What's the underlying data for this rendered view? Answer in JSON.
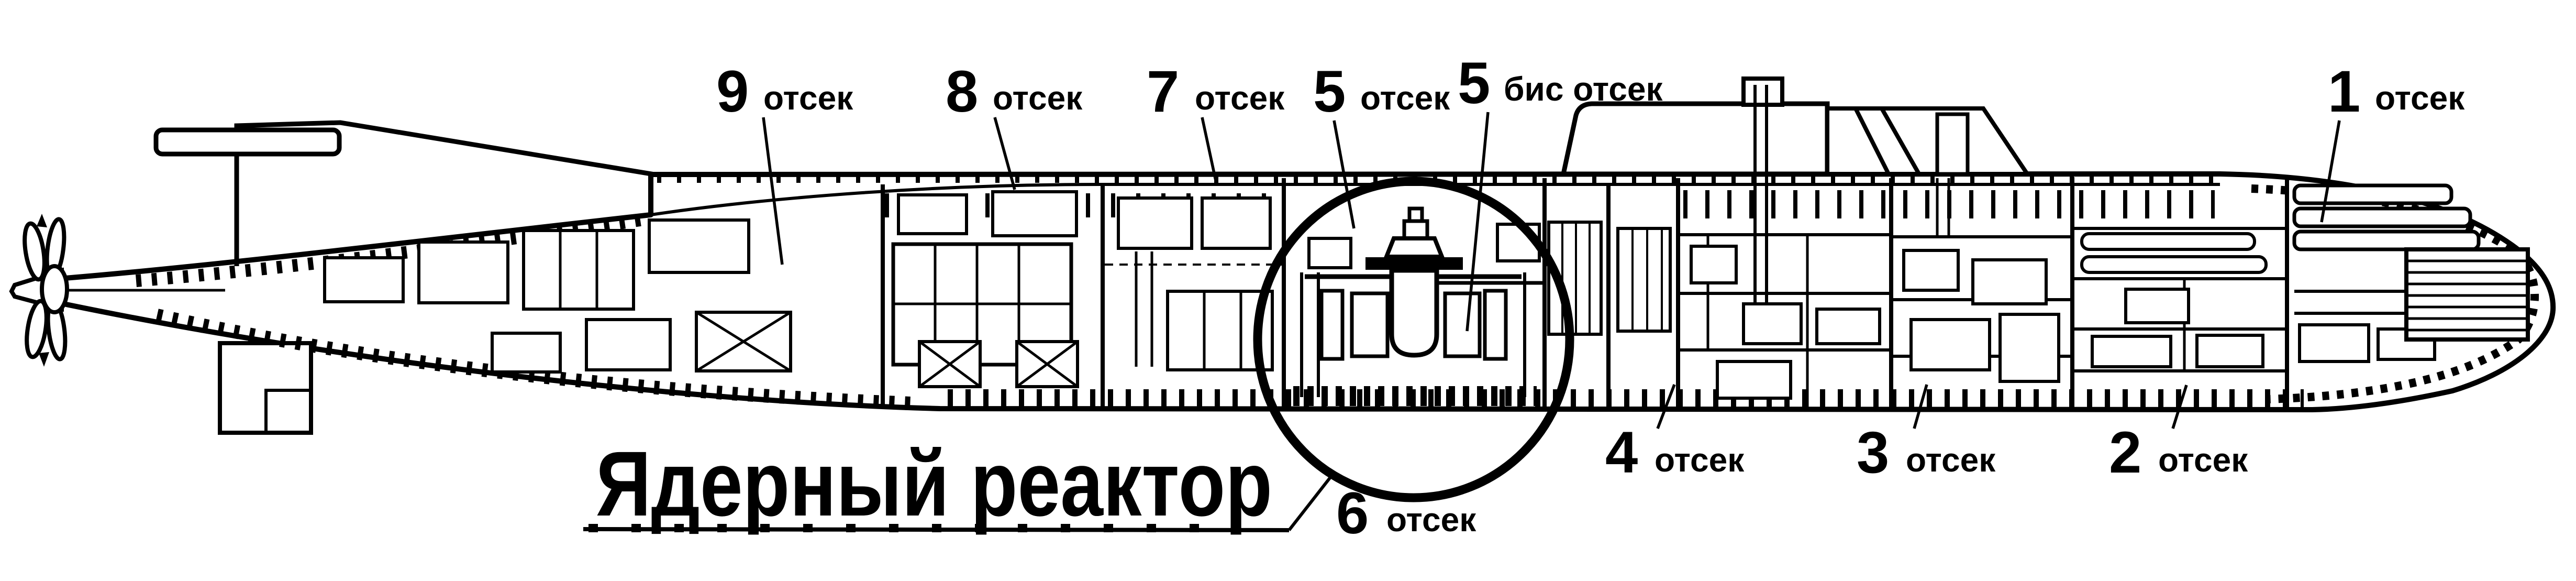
{
  "figure": {
    "type": "submarine-cutaway-diagram",
    "background": "#ffffff",
    "ink": "#000000",
    "highlight_shape": "circle"
  },
  "reactor": {
    "title": "Ядерный реактор"
  },
  "compartments": [
    {
      "key": "9",
      "number": "9",
      "word": "отсек"
    },
    {
      "key": "8",
      "number": "8",
      "word": "отсек"
    },
    {
      "key": "7",
      "number": "7",
      "word": "отсек"
    },
    {
      "key": "5",
      "number": "5",
      "word": "отсек"
    },
    {
      "key": "5bis",
      "number": "5",
      "word": "бис отсек"
    },
    {
      "key": "1",
      "number": "1",
      "word": "отсек"
    },
    {
      "key": "4",
      "number": "4",
      "word": "отсек"
    },
    {
      "key": "3",
      "number": "3",
      "word": "отсек"
    },
    {
      "key": "2",
      "number": "2",
      "word": "отсек"
    },
    {
      "key": "6",
      "number": "6",
      "word": "отсек"
    }
  ]
}
